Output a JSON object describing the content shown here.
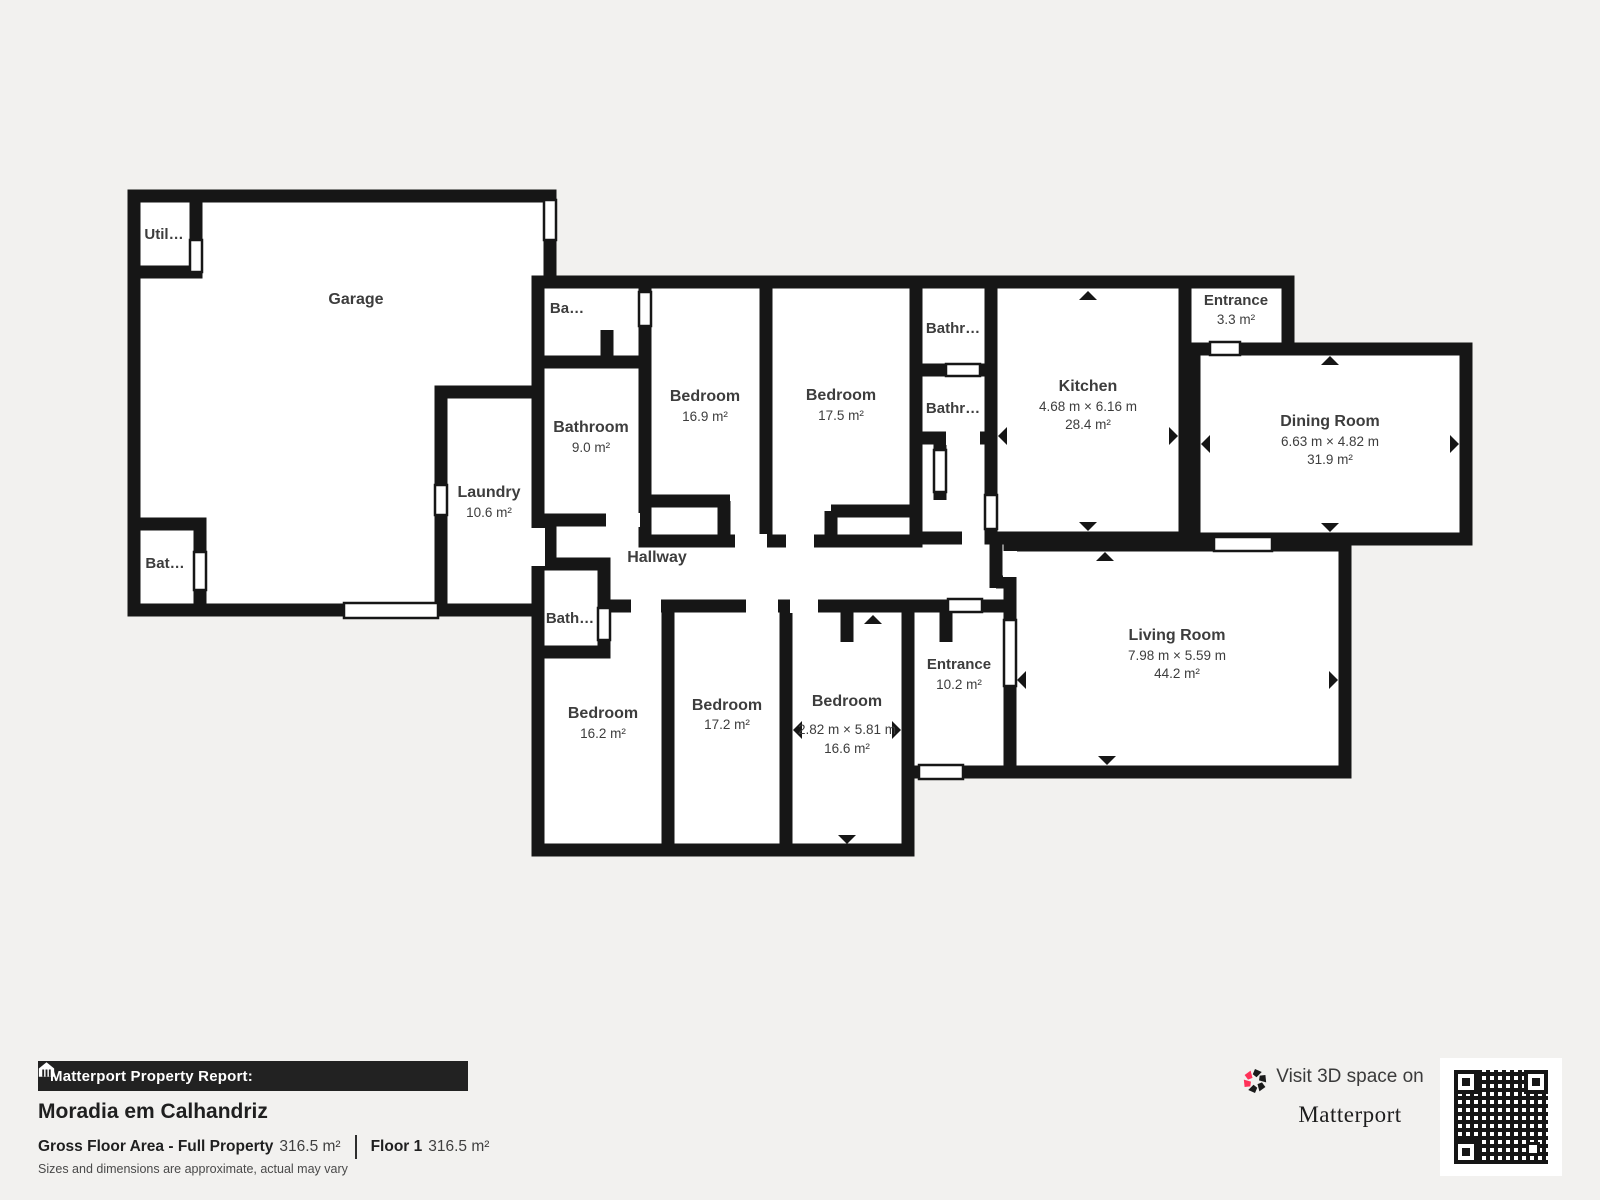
{
  "rooms": [
    {
      "id": "garage",
      "label": "Garage"
    },
    {
      "id": "utility",
      "label": "Util…"
    },
    {
      "id": "bathroom-garage",
      "label": "Bat…"
    },
    {
      "id": "laundry",
      "label": "Laundry",
      "area": "10.6 m²"
    },
    {
      "id": "bathroom-small-top",
      "label": "Ba…"
    },
    {
      "id": "bathroom-main",
      "label": "Bathroom",
      "area": "9.0 m²"
    },
    {
      "id": "bedroom-169",
      "label": "Bedroom",
      "area": "16.9 m²"
    },
    {
      "id": "bedroom-175",
      "label": "Bedroom",
      "area": "17.5 m²"
    },
    {
      "id": "bathroom-top-right",
      "label": "Bathr…"
    },
    {
      "id": "bathroom-mid-right",
      "label": "Bathr…"
    },
    {
      "id": "kitchen",
      "label": "Kitchen",
      "dims": "4.68 m × 6.16 m",
      "area": "28.4 m²"
    },
    {
      "id": "entrance-small",
      "label": "Entrance",
      "area": "3.3 m²"
    },
    {
      "id": "dining-room",
      "label": "Dining Room",
      "dims": "6.63 m × 4.82 m",
      "area": "31.9 m²"
    },
    {
      "id": "hallway",
      "label": "Hallway"
    },
    {
      "id": "bathroom-lower",
      "label": "Bath…"
    },
    {
      "id": "bedroom-162",
      "label": "Bedroom",
      "area": "16.2 m²"
    },
    {
      "id": "bedroom-172",
      "label": "Bedroom",
      "area": "17.2 m²"
    },
    {
      "id": "bedroom-166",
      "label": "Bedroom",
      "dims": "2.82 m × 5.81 m",
      "area": "16.6 m²"
    },
    {
      "id": "entrance-main",
      "label": "Entrance",
      "area": "10.2 m²"
    },
    {
      "id": "living-room",
      "label": "Living Room",
      "dims": "7.98 m × 5.59 m",
      "area": "44.2 m²"
    }
  ],
  "footer": {
    "report_label": "Matterport Property Report:",
    "property_name": "Moradia em Calhandriz",
    "gross_label": "Gross Floor Area - Full Property",
    "gross_value": "316.5 m²",
    "floor_label": "Floor 1",
    "floor_value": "316.5 m²",
    "disclaimer": "Sizes and dimensions are approximate, actual may vary"
  },
  "promo": {
    "visit_text": "Visit 3D space on",
    "brand": "Matterport"
  },
  "colors": {
    "wall": "#161616",
    "room_fill": "#ffffff",
    "background": "#f2f1ef",
    "accent_red": "#ff3158",
    "label_text": "#3d3d3d"
  }
}
